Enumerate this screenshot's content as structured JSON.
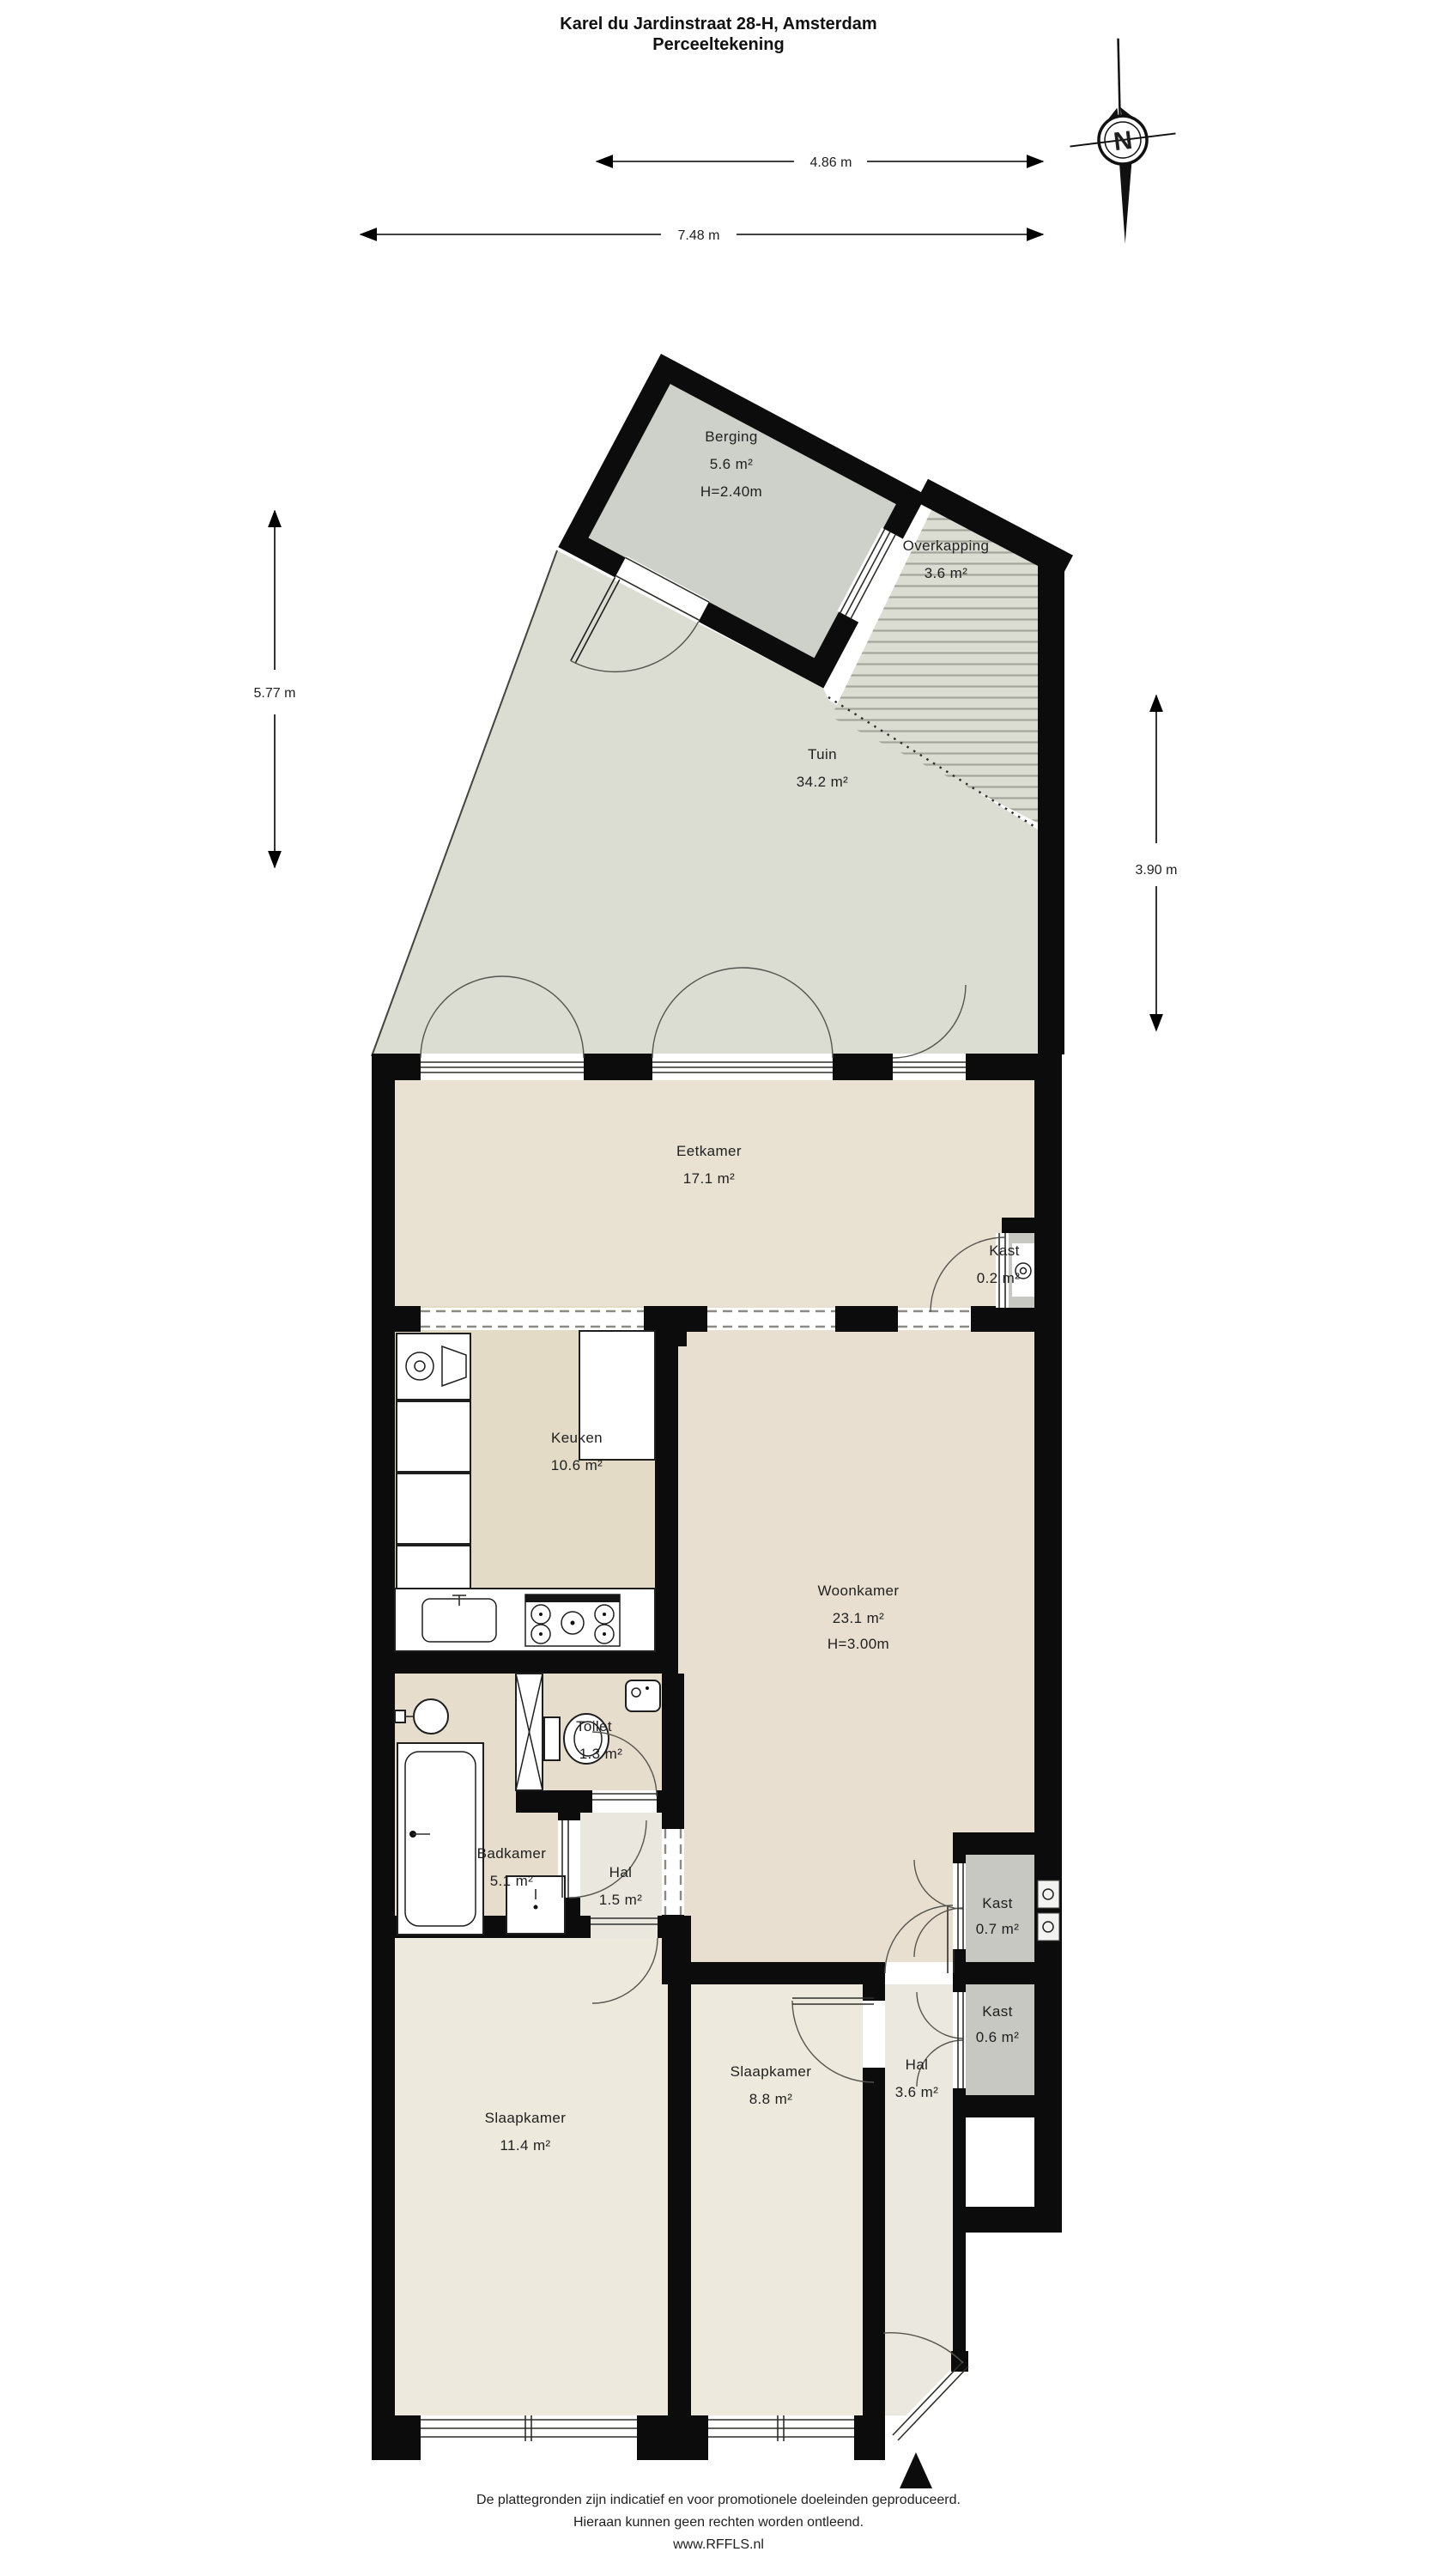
{
  "title": {
    "line1": "Karel du Jardinstraat 28-H, Amsterdam",
    "line2": "Perceeltekening"
  },
  "compass": {
    "label": "N"
  },
  "dimensions": {
    "top_inner": "4.86 m",
    "top_outer": "7.48 m",
    "left": "5.77 m",
    "right": "3.90 m"
  },
  "rooms": {
    "berging": {
      "name": "Berging",
      "area": "5.6 m²",
      "height": "H=2.40m"
    },
    "overkapping": {
      "name": "Overkapping",
      "area": "3.6 m²"
    },
    "tuin": {
      "name": "Tuin",
      "area": "34.2 m²"
    },
    "eetkamer": {
      "name": "Eetkamer",
      "area": "17.1 m²"
    },
    "kast_eetkamer": {
      "name": "Kast",
      "area": "0.2 m²"
    },
    "keuken": {
      "name": "Keuken",
      "area": "10.6 m²"
    },
    "woonkamer": {
      "name": "Woonkamer",
      "area": "23.1 m²",
      "height": "H=3.00m"
    },
    "toilet": {
      "name": "Toilet",
      "area": "1.3 m²"
    },
    "badkamer": {
      "name": "Badkamer",
      "area": "5.1 m²"
    },
    "hal_klein": {
      "name": "Hal",
      "area": "1.5 m²"
    },
    "kast_woonkamer": {
      "name": "Kast",
      "area": "0.7 m²"
    },
    "kast_hal": {
      "name": "Kast",
      "area": "0.6 m²"
    },
    "slaapkamer_groot": {
      "name": "Slaapkamer",
      "area": "11.4 m²"
    },
    "slaapkamer_klein": {
      "name": "Slaapkamer",
      "area": "8.8 m²"
    },
    "hal_groot": {
      "name": "Hal",
      "area": "3.6 m²"
    }
  },
  "footer": {
    "line1": "De plattegronden zijn indicatief en voor promotionele doeleinden geproduceerd.",
    "line2": "Hieraan kunnen geen rechten worden ontleend.",
    "line3": "www.RFFLS.nl"
  },
  "colors": {
    "wall": "#0c0c0c",
    "outdoor": "#dbdcd2",
    "berging_floor": "#ced1ca",
    "living_floor": "#e8dfd0",
    "kitchen_floor": "#e4dbc7",
    "bedroom_floor": "#edeadd",
    "closet_fill": "#c6c8c1",
    "background": "#ffffff"
  }
}
